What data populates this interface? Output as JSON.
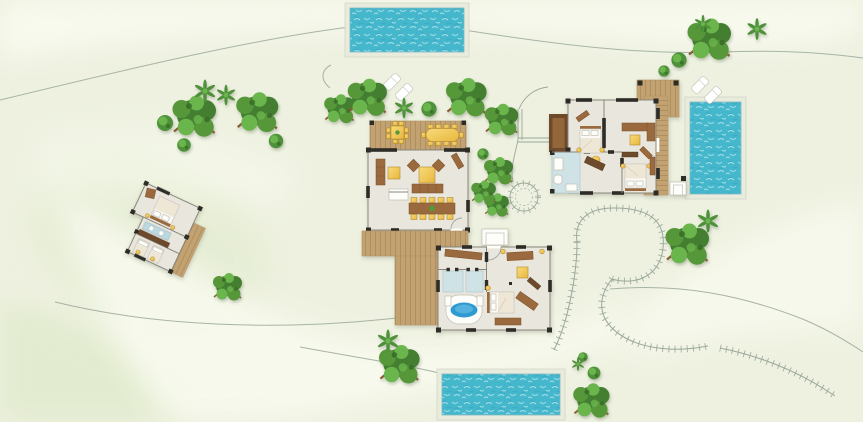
{
  "meta": {
    "description": "top-down resort villa site plan with three pools, four buildings, decks, trees and garden paths"
  },
  "palette": {
    "bg": "#eef1e0",
    "terrain_light": "#f8faee",
    "terrain_tint": "#e2ebcf",
    "pool_water": "#45b7cc",
    "pool_ripple": "#a8e0e6",
    "pool_ripple_dark": "#2f9db4",
    "pool_surround": "#e9ebdd",
    "deck": "#c3a272",
    "deck_dark": "#9c7a50",
    "terrace_dark": "#6f4a2a",
    "terrace_inner": "#93673a",
    "wall_dark": "#2e2c27",
    "wall_line": "#8a867c",
    "floor": "#e8e6dd",
    "bath_blue": "#cfe2e6",
    "vanity_blue": "#bcd8de",
    "tub_blue": "#2f9ad1",
    "tub_blue_light": "#5cb6e2",
    "furn_yellow_1": "#f7dc7a",
    "furn_yellow_2": "#e8b63e",
    "furn_brown": "#9a6a3e",
    "furn_brown_dark": "#6e4a2c",
    "bed_linen": "#fbfaf6",
    "bed_duvet": "#efe7d6",
    "tree_dark": "#447f31",
    "tree_mid": "#56973a",
    "tree_light": "#6ab54c",
    "bush_green": "#4f913a",
    "branch": "#8a5f38",
    "lounger": "#ffffff",
    "path_line": "#9aa89b"
  },
  "pools": [
    {
      "name": "pool-top",
      "x": 350,
      "y": 8,
      "w": 114,
      "h": 44
    },
    {
      "name": "pool-right",
      "x": 690,
      "y": 102,
      "w": 51,
      "h": 92
    },
    {
      "name": "pool-bottom",
      "x": 442,
      "y": 374,
      "w": 118,
      "h": 41
    }
  ],
  "trees": [
    {
      "type": "tree",
      "x": 195,
      "y": 118,
      "s": 1.5
    },
    {
      "type": "tree",
      "x": 258,
      "y": 114,
      "s": 1.45
    },
    {
      "type": "tree",
      "x": 340,
      "y": 110,
      "s": 1.05
    },
    {
      "type": "tree",
      "x": 368,
      "y": 99,
      "s": 1.35
    },
    {
      "type": "tree",
      "x": 467,
      "y": 99,
      "s": 1.4
    },
    {
      "type": "tree",
      "x": 502,
      "y": 121,
      "s": 1.15
    },
    {
      "type": "tree",
      "x": 499,
      "y": 172,
      "s": 1.0
    },
    {
      "type": "tree",
      "x": 497,
      "y": 206,
      "s": 0.85
    },
    {
      "type": "tree",
      "x": 484,
      "y": 193,
      "s": 0.85
    },
    {
      "type": "tree",
      "x": 710,
      "y": 41,
      "s": 1.5
    },
    {
      "type": "tree",
      "x": 688,
      "y": 246,
      "s": 1.5
    },
    {
      "type": "tree",
      "x": 400,
      "y": 366,
      "s": 1.4
    },
    {
      "type": "tree",
      "x": 592,
      "y": 402,
      "s": 1.25
    },
    {
      "type": "tree",
      "x": 228,
      "y": 288,
      "s": 1.0
    },
    {
      "type": "bush",
      "x": 165,
      "y": 123,
      "s": 1.0
    },
    {
      "type": "bush",
      "x": 184,
      "y": 145,
      "s": 0.85
    },
    {
      "type": "bush",
      "x": 276,
      "y": 141,
      "s": 0.9
    },
    {
      "type": "bush",
      "x": 429,
      "y": 109,
      "s": 0.95
    },
    {
      "type": "bush",
      "x": 483,
      "y": 154,
      "s": 0.7
    },
    {
      "type": "bush",
      "x": 679,
      "y": 60,
      "s": 0.95
    },
    {
      "type": "bush",
      "x": 664,
      "y": 71,
      "s": 0.7
    },
    {
      "type": "bush",
      "x": 583,
      "y": 357,
      "s": 0.6
    },
    {
      "type": "bush",
      "x": 594,
      "y": 373,
      "s": 0.8
    },
    {
      "type": "shrub",
      "x": 205,
      "y": 91,
      "s": 1.0
    },
    {
      "type": "shrub",
      "x": 226,
      "y": 95,
      "s": 0.9
    },
    {
      "type": "shrub",
      "x": 404,
      "y": 108,
      "s": 0.9
    },
    {
      "type": "shrub",
      "x": 388,
      "y": 341,
      "s": 1.0
    },
    {
      "type": "shrub",
      "x": 708,
      "y": 221,
      "s": 1.0
    },
    {
      "type": "shrub",
      "x": 757,
      "y": 29,
      "s": 0.95
    },
    {
      "type": "shrub",
      "x": 703,
      "y": 24,
      "s": 0.8
    },
    {
      "type": "shrub",
      "x": 578,
      "y": 364,
      "s": 0.6
    }
  ],
  "loungers": [
    {
      "x": 392,
      "y": 82,
      "r": 45
    },
    {
      "x": 404,
      "y": 92,
      "r": 45
    },
    {
      "x": 700,
      "y": 85,
      "r": 45
    },
    {
      "x": 713,
      "y": 95,
      "r": 45
    }
  ]
}
